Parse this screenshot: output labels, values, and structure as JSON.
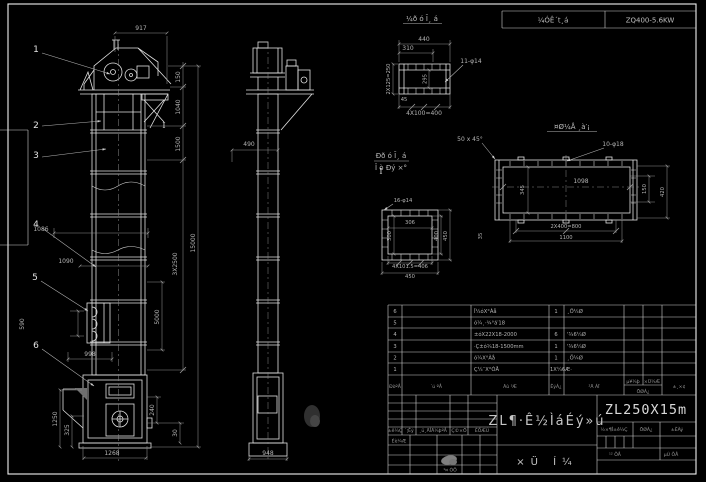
{
  "colors": {
    "bg": "#000000",
    "line": "#e2e2e2",
    "dim": "#8f8f8f",
    "text": "#b4b4b4",
    "frame": "#f0f0f0"
  },
  "header_band": {
    "left": "¼ÓÊ´t¸á",
    "right": "ZQ400-5.6KW"
  },
  "section_marks": {
    "a": "I",
    "b": "I"
  },
  "front_view": {
    "callouts": [
      "1",
      "2",
      "3",
      "4",
      "5",
      "6"
    ],
    "dims": {
      "top": "917",
      "r150": "150",
      "r1040": "1040",
      "r1500": "1500",
      "r3x2500": "3X2500",
      "r5000": "5000",
      "r15000": "15000",
      "l1086": "1086",
      "l1090": "1090",
      "l590": "590",
      "l998": "998",
      "b1268": "1268",
      "bl1250": "1250",
      "bl325": "325",
      "br240": "240",
      "br30": "30"
    }
  },
  "side_view": {
    "dims": {
      "w490": "490",
      "b948": "948"
    }
  },
  "detail_a": {
    "title": "¼ð ó Ī¸ á",
    "hole_note": "11-φ14",
    "dims": {
      "w440": "440",
      "w310": "310",
      "l2x125": "2X125=250",
      "h295": "295",
      "s45": "45",
      "b4x100": "4X100=400"
    }
  },
  "detail_b": {
    "title": "¤Ø¼Å ¸à′¡",
    "chamfer": "50 x 45°",
    "hole_note": "10-φ18",
    "dims": {
      "w1098": "1098",
      "h345": "345",
      "b2x400": "2X400=800",
      "b1100": "1100",
      "l35": "35",
      "r150": "150",
      "r420": "420"
    }
  },
  "detail_c": {
    "title_1": "Ðð ó Ī¸ á",
    "title_2": "Î ò Ðý ×°",
    "hole_note": "16-φ14",
    "dims": {
      "w306": "306",
      "h300": "300",
      "r400": "400",
      "r450": "450",
      "b4x101": "4X101.5=406",
      "b450": "450"
    }
  },
  "bom": {
    "headers": {
      "seq": "ÐòºÅ",
      "code": "´ú ºÅ",
      "name": "Ãû ³Æ",
      "qty": "ÊýÁ¿",
      "material": "²Ä ÁÏ",
      "unit": "µ¥¼þ",
      "total": "×Ü¼Æ",
      "weight": "ÖØÁ¿",
      "remark": "±¸×¢"
    },
    "rows": [
      {
        "seq": "6",
        "code": "",
        "name": "Î¼óX°Àå",
        "qty": "1",
        "material": "¸Ö¼Ø"
      },
      {
        "seq": "5",
        "code": "",
        "name": "ó¼¸·¾°á′18",
        "qty": "",
        "material": ""
      },
      {
        "seq": "4",
        "code": "",
        "name": "±óX22X18-2000",
        "qty": "6",
        "material": "'¾6¼Ø"
      },
      {
        "seq": "3",
        "code": "",
        "name": "·Ç±ó¾18-1500mm",
        "qty": "1",
        "material": "'¾6¼Ø"
      },
      {
        "seq": "2",
        "code": "",
        "name": "ó¼X°Àå",
        "qty": "1",
        "material": "¸Ö¼Ø"
      },
      {
        "seq": "1",
        "code": "",
        "name": "Ç¼¨X°ÓÅ",
        "qty": "1X¼6Æ·",
        "material": ""
      }
    ]
  },
  "title_block": {
    "model": "ZL250X15m",
    "product": "ZL¶·Ê½ÌáÉý»ú",
    "sheet_name": "×Ü Í¼",
    "rev_row": [
      "±ê¼Ç",
      "´¦Êý",
      "¸ü¸ÄÎÄ¼þºÅ",
      "Ç©×Ö",
      "ÈÕÆÚ"
    ],
    "sig_rows": [
      "Éè¼Æ",
      "¹¤ ÒÕ"
    ],
    "info_row": [
      "½×¶Î±ê¼Ç",
      "ÖØÁ¿",
      "±ÈÀý"
    ],
    "sheet_row": [
      "¹² ÕÅ",
      "µÚ ÕÅ"
    ]
  }
}
